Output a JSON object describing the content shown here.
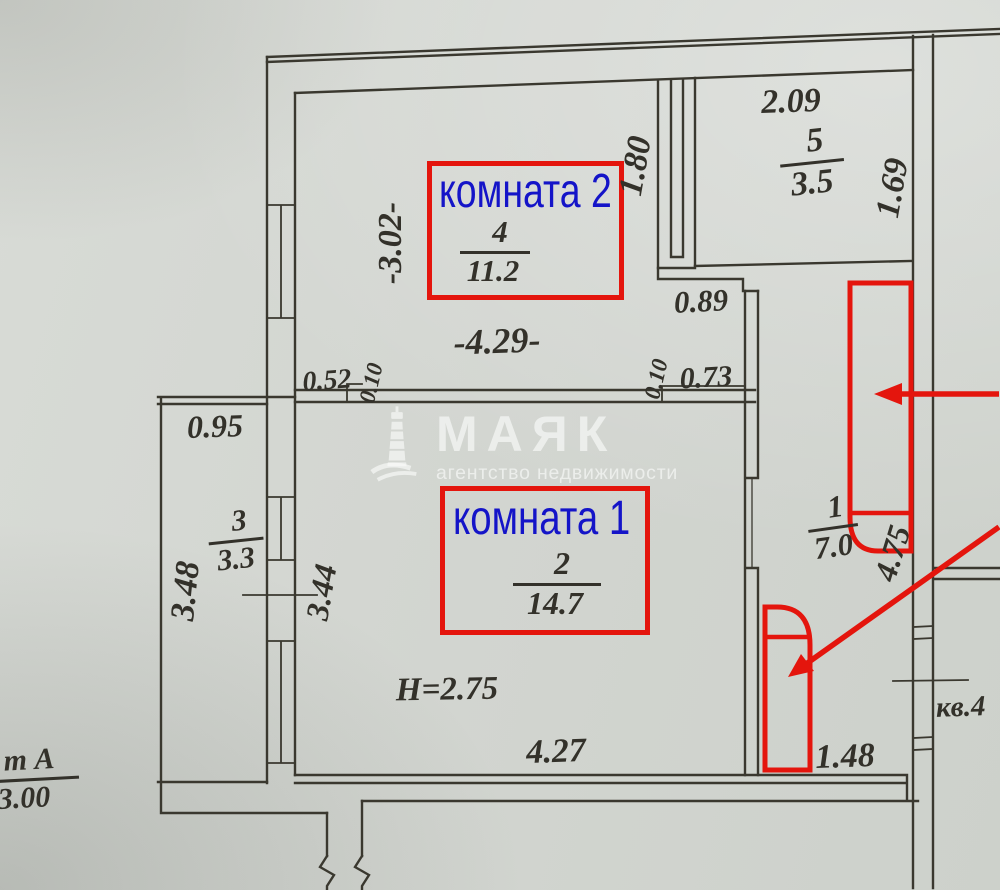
{
  "colors": {
    "paper": "#d3d6d1",
    "wall_line": "#3a382f",
    "annotation_red": "#e4150d",
    "room_label_blue": "#1414c8",
    "dimension_text": "#33312a"
  },
  "watermark": {
    "name": "МАЯК",
    "tagline": "агентство недвижимости"
  },
  "rooms": {
    "room2": {
      "label": "комната 2",
      "number": "4",
      "area": "11.2"
    },
    "room1": {
      "label": "комната 1",
      "number": "2",
      "area": "14.7"
    },
    "room5": {
      "number": "5",
      "area": "3.5"
    },
    "room3": {
      "number": "3",
      "area": "3.3"
    },
    "hall": {
      "number": "1",
      "area": "7.0"
    }
  },
  "dims": {
    "w209": "2.09",
    "h169": "1.69",
    "h180": "1.80",
    "h302": "-3.02-",
    "w429": "-4.29-",
    "w089": "0.89",
    "w052": "0.52",
    "n010a": "0.10",
    "n010b": "0.10",
    "w073": "0.73",
    "w095": "0.95",
    "h348": "3.48",
    "h344": "3.44",
    "h475": "4.75",
    "height": "H=2.75",
    "w427": "4.27",
    "w148": "1.48",
    "apt": "кв.4"
  },
  "litera": {
    "top": "т А",
    "bottom": "3.00"
  }
}
